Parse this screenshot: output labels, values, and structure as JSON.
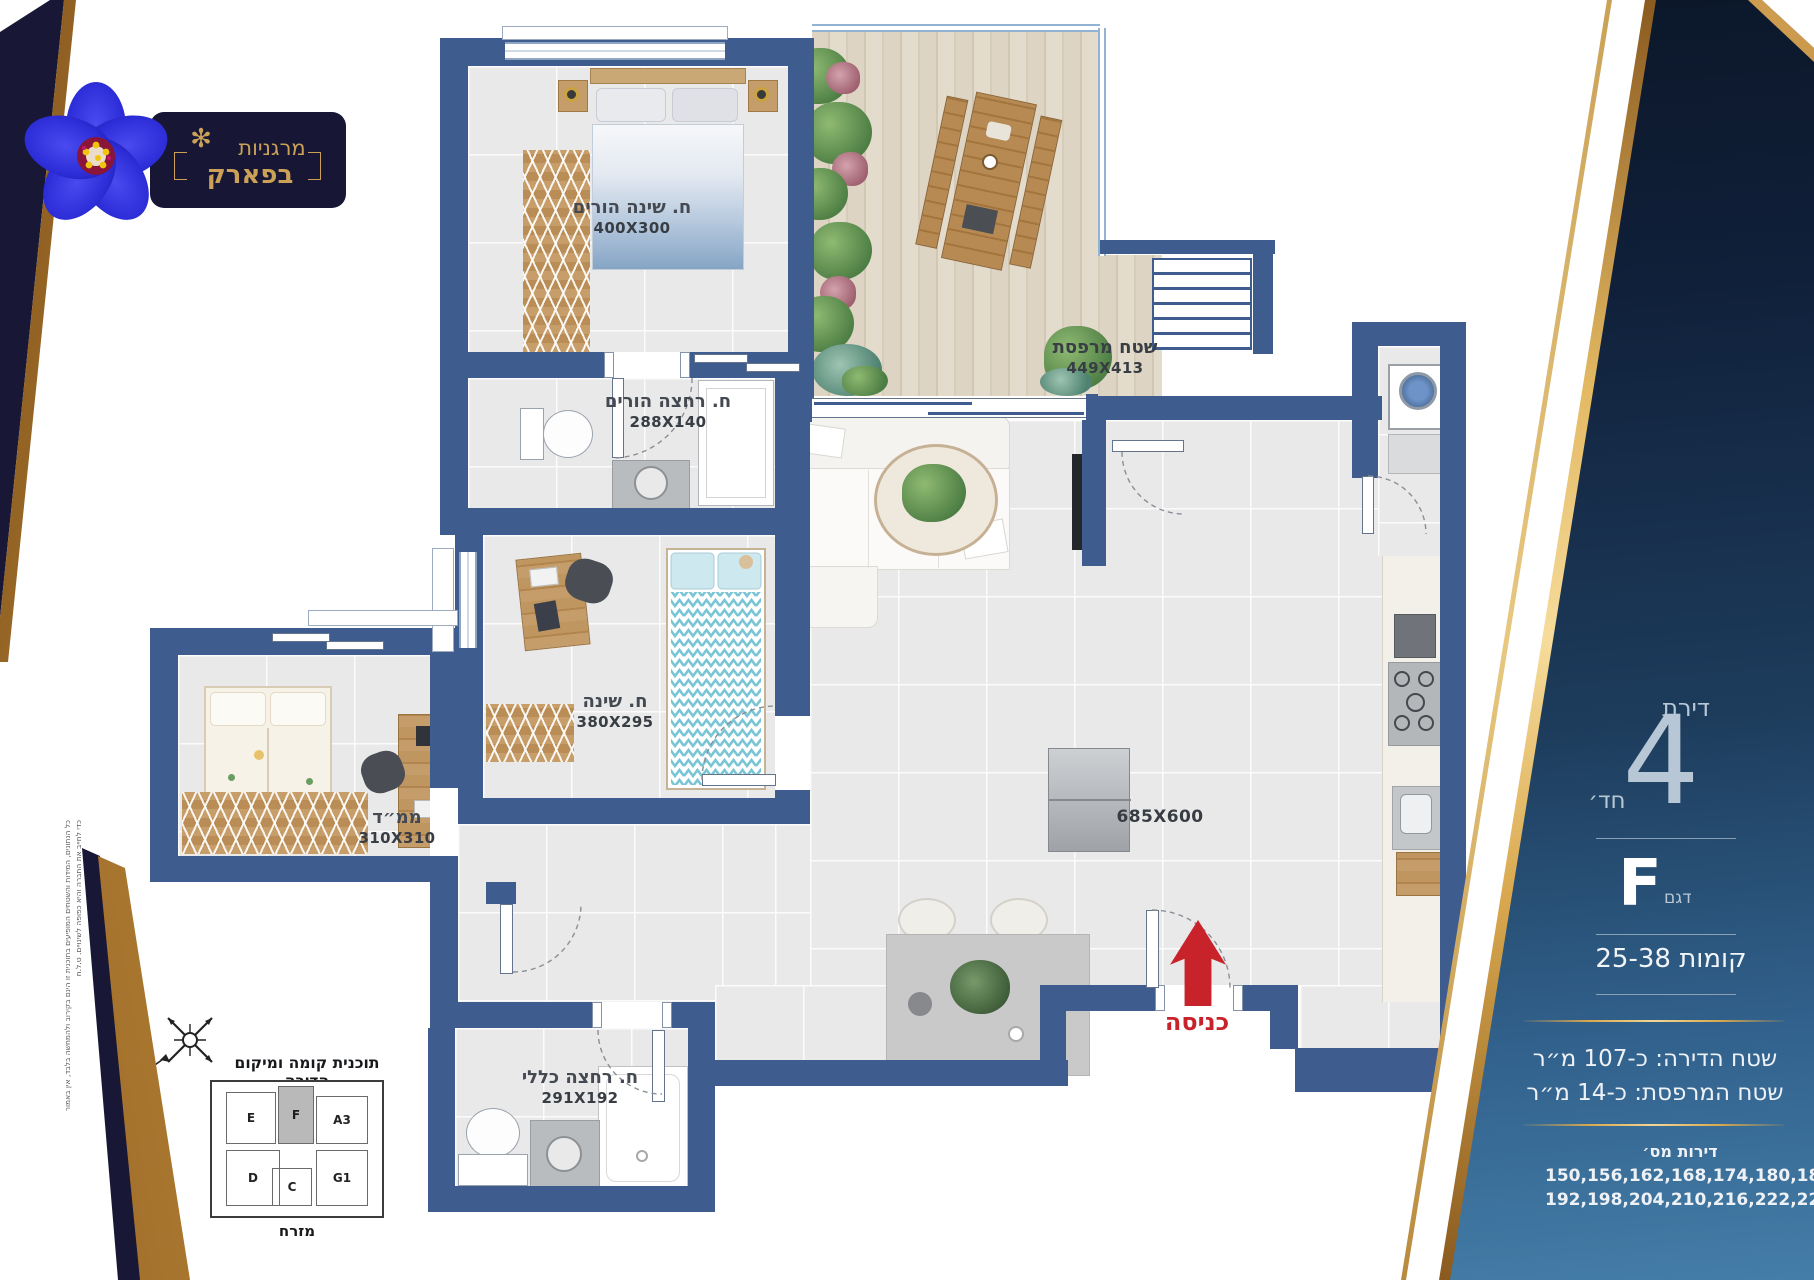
{
  "brand": {
    "line1": "מרגניות",
    "line2": "בפארק"
  },
  "side_panel": {
    "apartment_label": "דירת",
    "rooms_number": "4",
    "rooms_suffix": "חד׳",
    "model_letter": "F",
    "model_label": "דגם",
    "floors": "קומות 25-38",
    "apartment_area": "שטח הדירה:  כ-107 מ״ר",
    "balcony_area": "שטח המרפסת:  כ-14 מ״ר",
    "apartments_title": "דירות מס׳",
    "apartments_line1": "150,156,162,168,174,180,186",
    "apartments_line2": "192,198,204,210,216,222,228"
  },
  "plan": {
    "rooms": [
      {
        "id": "master-bedroom",
        "name": "ח. שינה הורים",
        "dims": "400X300"
      },
      {
        "id": "master-bath",
        "name": "ח. רחצה הורים",
        "dims": "288X140"
      },
      {
        "id": "bedroom",
        "name": "ח. שינה",
        "dims": "380X295"
      },
      {
        "id": "mamad",
        "name": "ממ״ד",
        "dims": "310X310"
      },
      {
        "id": "bath",
        "name": "ח. רחצה כללי",
        "dims": "291X192"
      },
      {
        "id": "balcony",
        "name": "שטח מרפסת",
        "dims": "449X413"
      },
      {
        "id": "living",
        "name": "",
        "dims": "685X600"
      }
    ],
    "entrance_label": "כניסה"
  },
  "key_plan": {
    "title": "תוכנית קומה ומיקום הדירה",
    "east_label": "מזרח",
    "units": [
      "E",
      "F",
      "A3",
      "D",
      "C",
      "G1"
    ],
    "highlighted_unit": "F",
    "north_letter": "צ"
  },
  "disclaimer": "כל הנתונים, המידות והשטחים המופיעים בתוכנית זו הינם בקירוב ולהמחשה בלבד, אין באמור כדי לחייב את החברה והיא כפופה לשינויים. ט.ל.ח",
  "colors": {
    "wall": "#3e5c8e",
    "gold": "#d9a84e",
    "accent_red": "#c8232b",
    "panel_top": "#0a1322",
    "panel_bottom": "#447ea8",
    "floor": "#e9e9ea",
    "deck": "#ddd4c3"
  }
}
